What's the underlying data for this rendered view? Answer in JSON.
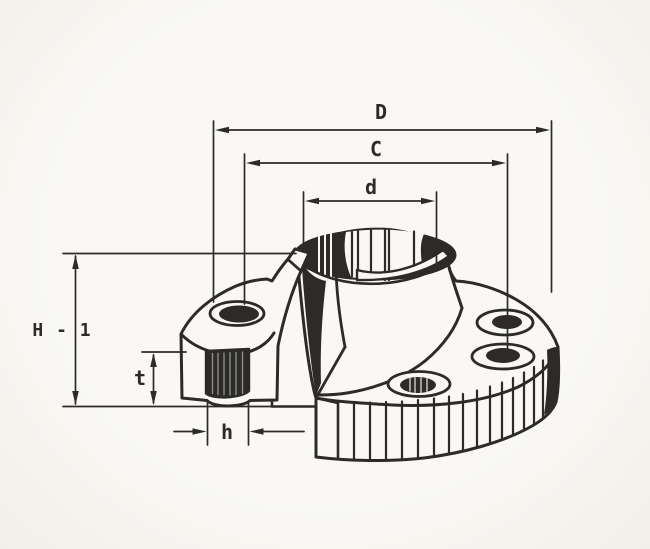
{
  "drawing": {
    "subject": "weld-neck-flange-cutaway-section",
    "style": {
      "ink_color": "#2c2b27",
      "paper_color": "#f8f7f3"
    },
    "dimension_labels": {
      "outer_diameter": "D",
      "bolt_circle_diameter": "C",
      "hub_top_diameter": "d",
      "overall_height": "H - 1",
      "flange_thickness": "t",
      "bolt_hole_diameter": "h"
    }
  }
}
